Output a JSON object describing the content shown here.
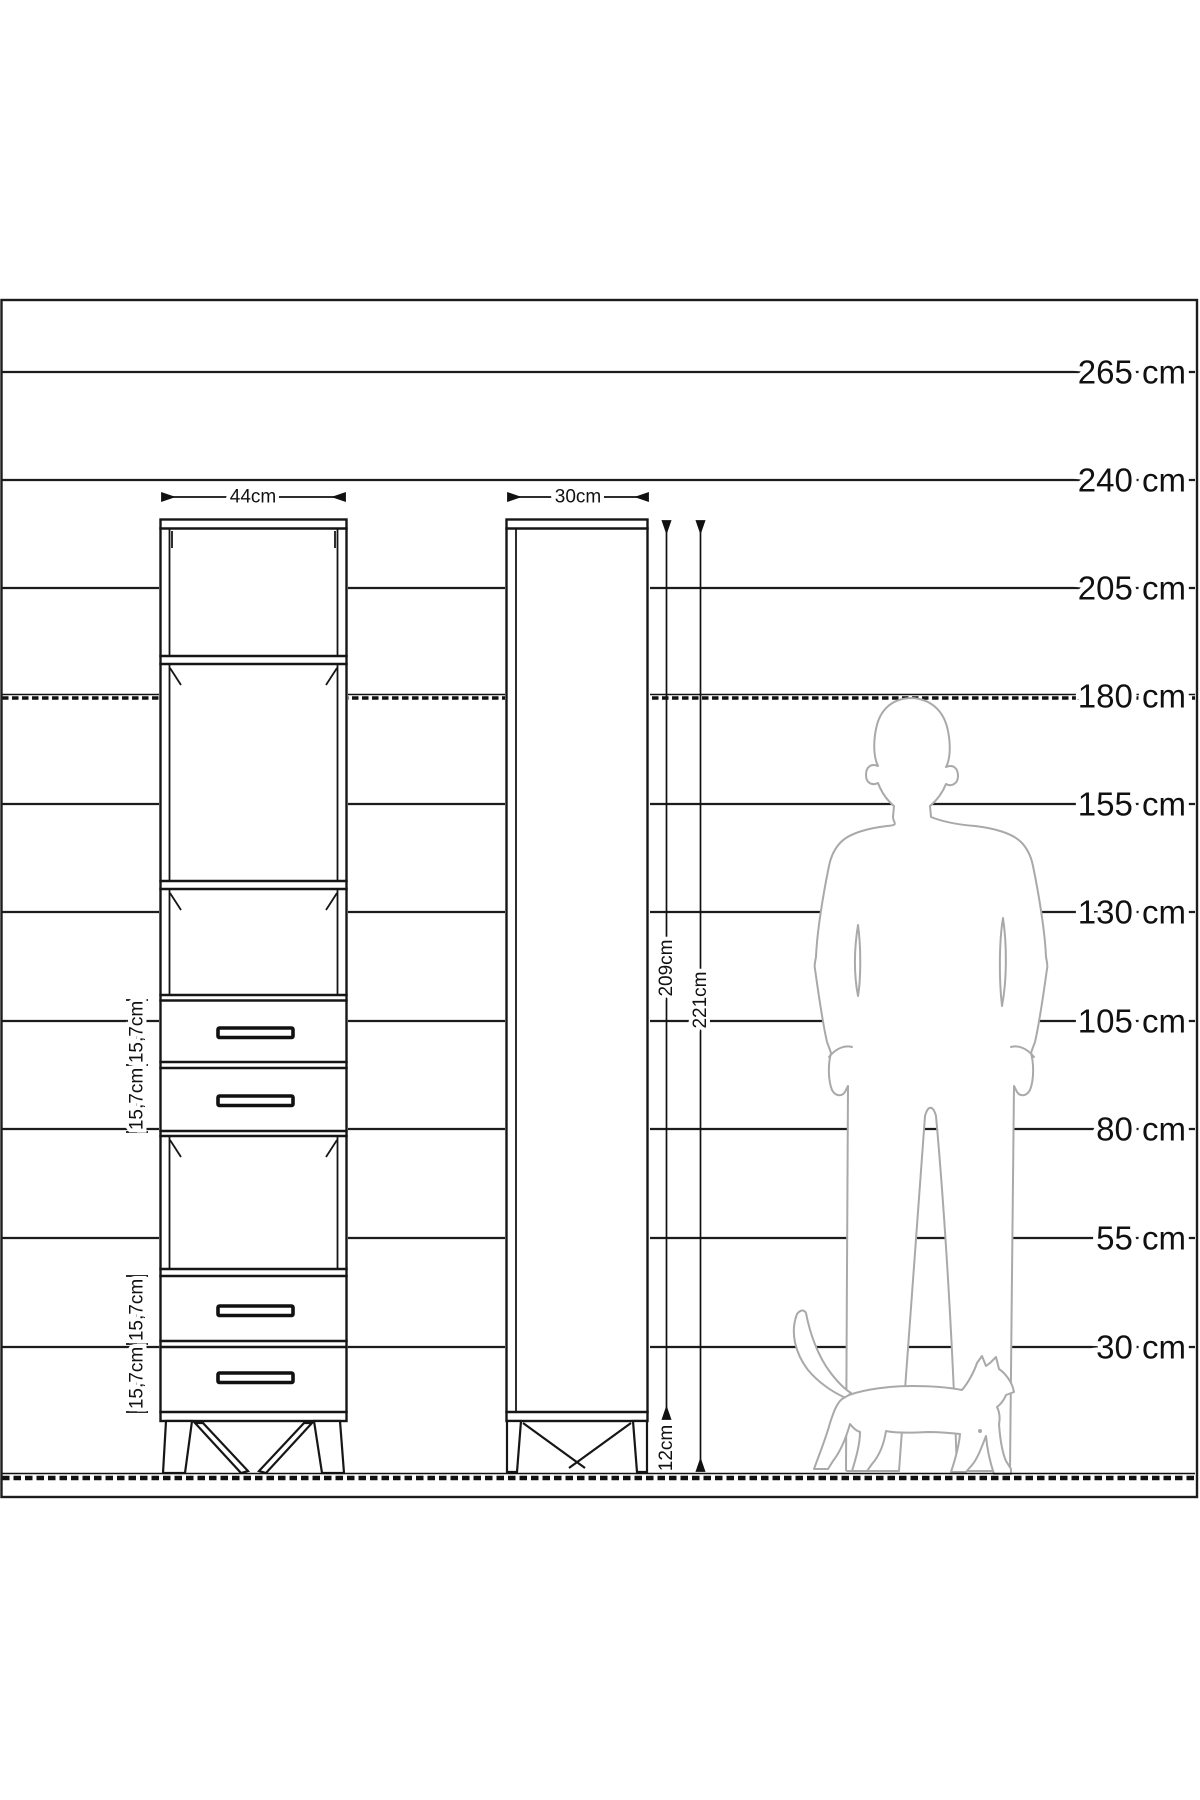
{
  "diagram": {
    "scale": {
      "unit": "cm",
      "labels": [
        "265 cm",
        "240 cm",
        "205 cm",
        "180 cm",
        "155 cm",
        "130 cm",
        "105 cm",
        "80 cm",
        "55 cm",
        "30 cm"
      ]
    },
    "front_view": {
      "width_label": "44cm",
      "drawer_labels": [
        "15,7cm",
        "15,7cm",
        "15,7cm",
        "15,7cm"
      ]
    },
    "side_view": {
      "depth_label": "30cm",
      "body_height_label": "209cm",
      "total_height_label": "221cm",
      "leg_height_label": "12cm"
    }
  }
}
